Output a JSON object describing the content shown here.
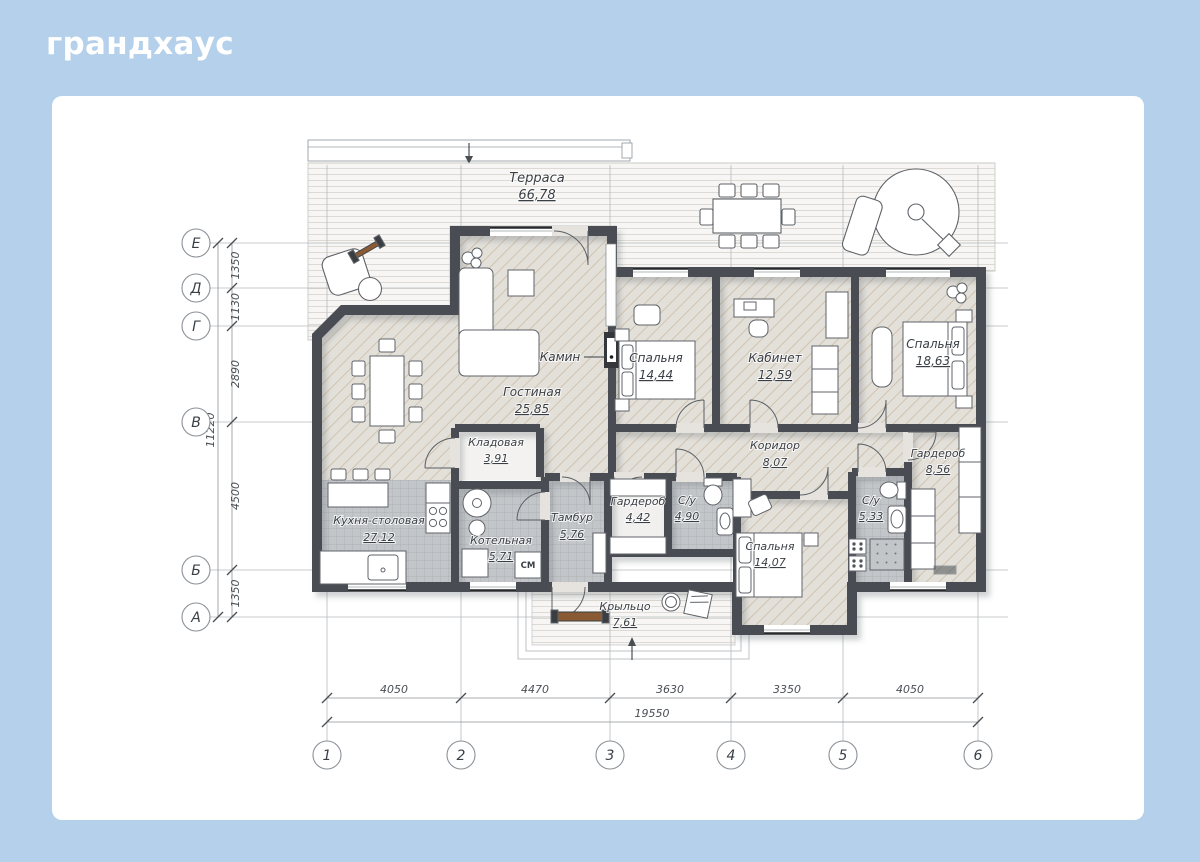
{
  "logo": "грандхаус",
  "terrace": {
    "name": "Терраса",
    "area": "66,78"
  },
  "rooms": [
    {
      "name": "Гостиная",
      "area": "25,85"
    },
    {
      "name": "Спальня",
      "area": "14,44"
    },
    {
      "name": "Кабинет",
      "area": "12,59"
    },
    {
      "name": "Спальня",
      "area": "18,63"
    },
    {
      "name": "Коридор",
      "area": "8,07"
    },
    {
      "name": "Кладовая",
      "area": "3,91"
    },
    {
      "name": "Кухня-столовая",
      "area": "27,12"
    },
    {
      "name": "Котельная",
      "area": "5,71"
    },
    {
      "name": "Тамбур",
      "area": "5,76"
    },
    {
      "name": "Гардероб",
      "area": "4,42"
    },
    {
      "name": "С/у",
      "area": "4,90"
    },
    {
      "name": "Спальня",
      "area": "14,07"
    },
    {
      "name": "С/у",
      "area": "5,33"
    },
    {
      "name": "Гардероб",
      "area": "8,56"
    },
    {
      "name": "Крыльцо",
      "area": "7,61"
    }
  ],
  "labels": {
    "fireplace": "Камин",
    "washer": "СМ"
  },
  "axes": {
    "rows": [
      "Е",
      "Д",
      "Г",
      "В",
      "Б",
      "А"
    ],
    "cols": [
      "1",
      "2",
      "3",
      "4",
      "5",
      "6"
    ]
  },
  "dims": {
    "vertical": {
      "segments": [
        "1350",
        "1130",
        "2890",
        "4500",
        "1350"
      ],
      "total": "11220"
    },
    "horizontal": {
      "segments": [
        "4050",
        "4470",
        "3630",
        "3350",
        "4050"
      ],
      "total": "19550"
    }
  },
  "colors": {
    "background": "#b4d0ea",
    "card": "#ffffff",
    "wall": "#4a4e53",
    "wood": "#8a5a35"
  }
}
